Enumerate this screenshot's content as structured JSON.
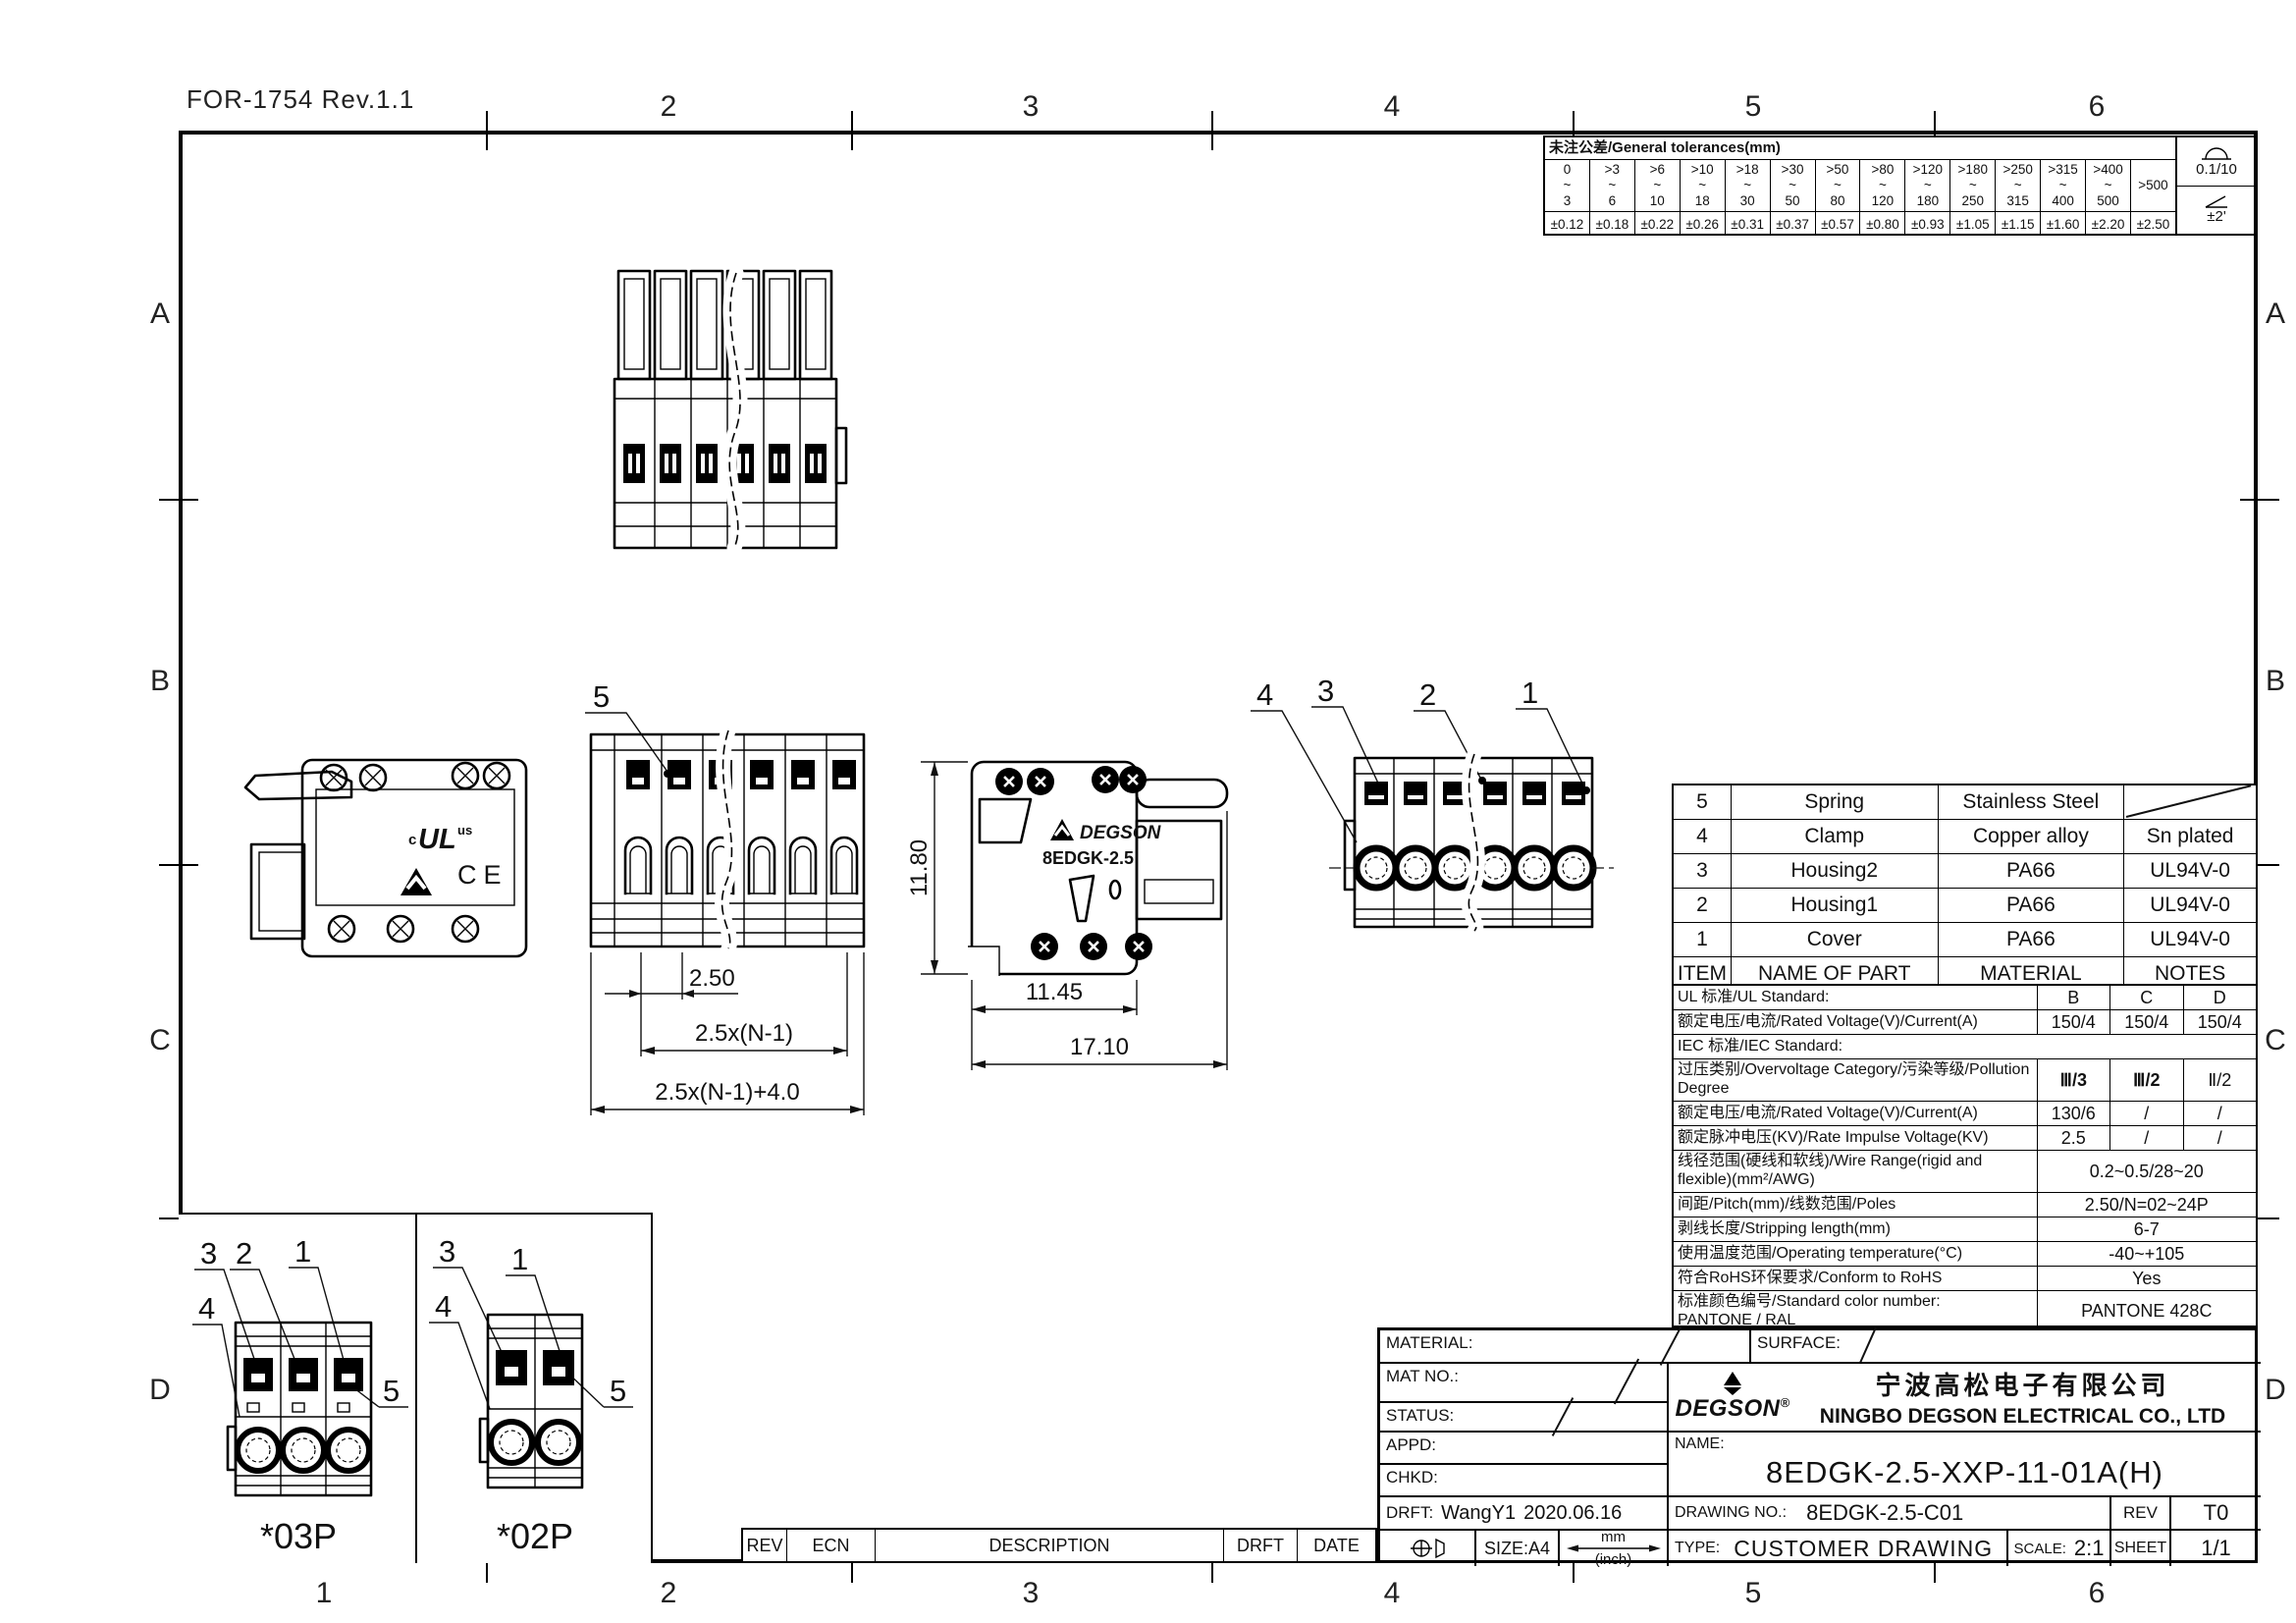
{
  "form_ref": "FOR-1754 Rev.1.1",
  "grid": {
    "top": [
      "2",
      "3",
      "4",
      "5",
      "6"
    ],
    "bottom": [
      "1",
      "2",
      "3",
      "4",
      "5",
      "6"
    ],
    "left": [
      "A",
      "B",
      "C",
      "D"
    ],
    "right": [
      "A",
      "B",
      "C",
      "D"
    ]
  },
  "tolerance_table": {
    "title": "未注公差/General tolerances(mm)",
    "ranges": [
      "0\n~\n3",
      ">3\n~\n6",
      ">6\n~\n10",
      ">10\n~\n18",
      ">18\n~\n30",
      ">30\n~\n50",
      ">50\n~\n80",
      ">80\n~\n120",
      ">120\n~\n180",
      ">180\n~\n250",
      ">250\n~\n315",
      ">315\n~\n400",
      ">400\n~\n500",
      ">500"
    ],
    "values": [
      "±0.12",
      "±0.18",
      "±0.22",
      "±0.26",
      "±0.31",
      "±0.37",
      "±0.57",
      "±0.80",
      "±0.93",
      "±1.05",
      "±1.15",
      "±1.60",
      "±2.20",
      "±2.50"
    ],
    "flatness": "0.1/10",
    "angle": "±2'"
  },
  "parts_table": {
    "headers": {
      "item": "ITEM",
      "name": "NAME OF PART",
      "material": "MATERIAL",
      "notes": "NOTES"
    },
    "rows": [
      {
        "item": "5",
        "name": "Spring",
        "material": "Stainless Steel",
        "notes": ""
      },
      {
        "item": "4",
        "name": "Clamp",
        "material": "Copper alloy",
        "notes": "Sn plated"
      },
      {
        "item": "3",
        "name": "Housing2",
        "material": "PA66",
        "notes": "UL94V-0"
      },
      {
        "item": "2",
        "name": "Housing1",
        "material": "PA66",
        "notes": "UL94V-0"
      },
      {
        "item": "1",
        "name": "Cover",
        "material": "PA66",
        "notes": "UL94V-0"
      }
    ]
  },
  "spec_table": {
    "rows": [
      {
        "label": "UL 标准/UL Standard:",
        "b": "B",
        "c": "C",
        "d": "D"
      },
      {
        "label": "额定电压/电流/Rated Voltage(V)/Current(A)",
        "b": "150/4",
        "c": "150/4",
        "d": "150/4"
      },
      {
        "label": "IEC 标准/IEC Standard:"
      },
      {
        "label": "过压类别/Overvoltage Category/污染等级/Pollution Degree",
        "b": "Ⅲ/3",
        "c": "Ⅲ/2",
        "d": "Ⅱ/2"
      },
      {
        "label": "额定电压/电流/Rated Voltage(V)/Current(A)",
        "b": "130/6",
        "c": "/",
        "d": "/"
      },
      {
        "label": "额定脉冲电压(KV)/Rate Impulse Voltage(KV)",
        "b": "2.5",
        "c": "/",
        "d": "/"
      },
      {
        "label": "线径范围(硬线和软线)/Wire Range(rigid and flexible)(mm²/AWG)",
        "value": "0.2~0.5/28~20"
      },
      {
        "label": "间距/Pitch(mm)/线数范围/Poles",
        "value": "2.50/N=02~24P"
      },
      {
        "label": "剥线长度/Stripping length(mm)",
        "value": "6-7"
      },
      {
        "label": "使用温度范围/Operating temperature(°C)",
        "value": "-40~+105"
      },
      {
        "label": "符合RoHS环保要求/Conform to RoHS",
        "value": "Yes"
      },
      {
        "label": "标准颜色编号/Standard color number:\nPANTONE / RAL",
        "value": "PANTONE 428C"
      }
    ]
  },
  "title_block": {
    "material_label": "MATERIAL:",
    "surface_label": "SURFACE:",
    "mat_no_label": "MAT NO.:",
    "status_label": "STATUS:",
    "appd_label": "APPD:",
    "chkd_label": "CHKD:",
    "drft_label": "DRFT:",
    "drft_name": "WangY1",
    "drft_date": "2020.06.16",
    "brand": "DEGSON",
    "brand_reg": "®",
    "company_cn": "宁波高松电子有限公司",
    "company_en": "NINGBO DEGSON ELECTRICAL CO., LTD",
    "name_label": "NAME:",
    "part_number": "8EDGK-2.5-XXP-11-01A(H)",
    "drawing_no_label": "DRAWING NO.:",
    "drawing_no": "8EDGK-2.5-C01",
    "rev_label": "REV",
    "rev_value": "T0",
    "size_label": "SIZE:A4",
    "unit_mm": "mm",
    "unit_inch": "(inch)",
    "type_label": "TYPE:",
    "type_value": "CUSTOMER DRAWING",
    "scale_label": "SCALE:",
    "scale_value": "2:1",
    "sheet_label": "SHEET",
    "sheet_value": "1/1"
  },
  "revision_strip": {
    "rev": "REV",
    "ecn": "ECN",
    "description": "DESCRIPTION",
    "drft": "DRFT",
    "date": "DATE"
  },
  "views": {
    "front_center": {
      "callout": "5",
      "dim_pitch": "2.50",
      "dim_span": "2.5x(N-1)",
      "dim_total": "2.5x(N-1)+4.0"
    },
    "side_left": {
      "ul_c": "c",
      "ul": "UL",
      "ul_us": "us",
      "ce": "CE"
    },
    "side_right": {
      "brand": "DEGSON",
      "model": "8EDGK-2.5",
      "dim_height": "11.80",
      "dim_body": "11.45",
      "dim_total": "17.10"
    },
    "back": {
      "callout_4": "4",
      "callout_3": "3",
      "callout_2": "2",
      "callout_1": "1"
    },
    "variant_03p": {
      "label": "*03P",
      "co3": "3",
      "co2": "2",
      "co1": "1",
      "co4": "4",
      "co5": "5"
    },
    "variant_02p": {
      "label": "*02P",
      "co3": "3",
      "co1": "1",
      "co4": "4",
      "co5": "5"
    }
  }
}
